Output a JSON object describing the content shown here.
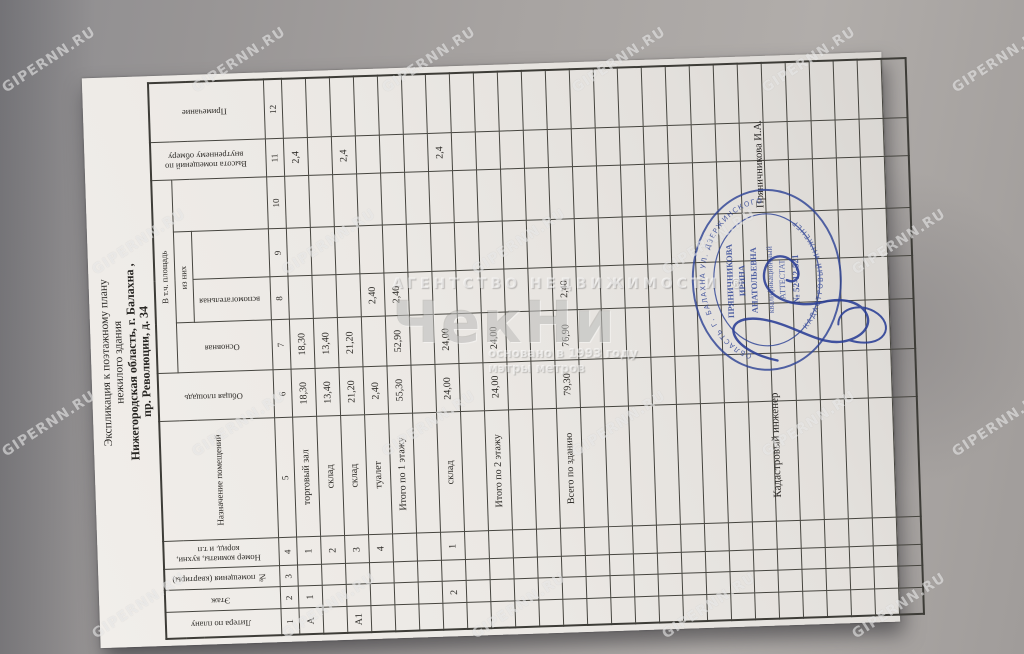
{
  "title": {
    "line1": "Экспликация к поэтажному плану",
    "line2": "нежилого здания",
    "line3": "Нижегородская область, г. Балахна ,",
    "line4": "пр. Революции, д. 34"
  },
  "table": {
    "headers": {
      "col1": "Литера по плану",
      "col2": "Этаж",
      "col3": "№ помещения (квартиры)",
      "col4": "Номер комнаты, кухни, корид. и т.п",
      "col5": "Назначение помещений",
      "col6": "Общая площадь",
      "group7_10": "В т.ч. площадь",
      "col7": "Основная",
      "group8_9": "из них",
      "col8": "вспомогательная",
      "col11": "Высота помещений по внутреннему обмеру",
      "col12": "Примечание"
    },
    "column_numbers": [
      "1",
      "2",
      "3",
      "4",
      "5",
      "6",
      "7",
      "8",
      "9",
      "10",
      "11",
      "12"
    ],
    "rows": [
      [
        "А",
        "1",
        "",
        "1",
        "торговый зал",
        "18,30",
        "18,30",
        "",
        "",
        "",
        "2,4",
        ""
      ],
      [
        "",
        "",
        "",
        "2",
        "склад",
        "13,40",
        "13,40",
        "",
        "",
        "",
        "",
        ""
      ],
      [
        "А1",
        "",
        "",
        "3",
        "склад",
        "21,20",
        "21,20",
        "",
        "",
        "",
        "2,4",
        ""
      ],
      [
        "",
        "",
        "",
        "4",
        "туалет",
        "2,40",
        "",
        "2,40",
        "",
        "",
        "",
        ""
      ],
      [
        "",
        "",
        "",
        "",
        "Итого по 1 этажу",
        "55,30",
        "52,90",
        "2,40",
        "",
        "",
        "",
        ""
      ],
      [
        "",
        "",
        "",
        "",
        "",
        "",
        "",
        "",
        "",
        "",
        "",
        ""
      ],
      [
        "",
        "2",
        "",
        "1",
        "склад",
        "24,00",
        "24,00",
        "",
        "",
        "",
        "2,4",
        ""
      ],
      [
        "",
        "",
        "",
        "",
        "",
        "",
        "",
        "",
        "",
        "",
        "",
        ""
      ],
      [
        "",
        "",
        "",
        "",
        "Итого по 2 этажу",
        "24,00",
        "24,00",
        "",
        "",
        "",
        "",
        ""
      ],
      [
        "",
        "",
        "",
        "",
        "",
        "",
        "",
        "",
        "",
        "",
        "",
        ""
      ],
      [
        "",
        "",
        "",
        "",
        "",
        "",
        "",
        "",
        "",
        "",
        "",
        ""
      ],
      [
        "",
        "",
        "",
        "",
        "Всего по зданию",
        "79,30",
        "76,90",
        "2,40",
        "",
        "",
        "",
        ""
      ],
      [
        "",
        "",
        "",
        "",
        "",
        "",
        "",
        "",
        "",
        "",
        "",
        ""
      ],
      [
        "",
        "",
        "",
        "",
        "",
        "",
        "",
        "",
        "",
        "",
        "",
        ""
      ],
      [
        "",
        "",
        "",
        "",
        "",
        "",
        "",
        "",
        "",
        "",
        "",
        ""
      ],
      [
        "",
        "",
        "",
        "",
        "",
        "",
        "",
        "",
        "",
        "",
        "",
        ""
      ],
      [
        "",
        "",
        "",
        "",
        "",
        "",
        "",
        "",
        "",
        "",
        "",
        ""
      ],
      [
        "",
        "",
        "",
        "",
        "",
        "",
        "",
        "",
        "",
        "",
        "",
        ""
      ],
      [
        "",
        "",
        "",
        "",
        "",
        "",
        "",
        "",
        "",
        "",
        "",
        ""
      ],
      [
        "",
        "",
        "",
        "",
        "",
        "",
        "",
        "",
        "",
        "",
        "",
        ""
      ],
      [
        "",
        "",
        "",
        "",
        "",
        "",
        "",
        "",
        "",
        "",
        "",
        ""
      ],
      [
        "",
        "",
        "",
        "",
        "",
        "",
        "",
        "",
        "",
        "",
        "",
        ""
      ],
      [
        "",
        "",
        "",
        "",
        "",
        "",
        "",
        "",
        "",
        "",
        "",
        ""
      ],
      [
        "",
        "",
        "",
        "",
        "",
        "",
        "",
        "",
        "",
        "",
        "",
        ""
      ],
      [
        "",
        "",
        "",
        "",
        "",
        "",
        "",
        "",
        "",
        "",
        "",
        ""
      ],
      [
        "",
        "",
        "",
        "",
        "",
        "",
        "",
        "",
        "",
        "",
        "",
        ""
      ]
    ]
  },
  "signature": {
    "label": "Кадастровый инженер",
    "name": "Пряничникова И.А."
  },
  "stamp": {
    "ring_address": "ОБЛАСТЬ Г. БАЛАХНА УЛ. ДЗЕРЖИНСКОГО Д. 38",
    "ring_title": "КАДАСТРОВЫЙ ИНЖЕНЕР",
    "name_line1": "ПРЯНИЧНИКОВА",
    "name_line2": "ИРИНА",
    "name_line3": "АНАТОЛЬЕВНА",
    "attest_line1": "квалификационный",
    "attest_line2": "АТТЕСТАТ",
    "attest_line3": "№ 52-12-521"
  },
  "watermark": {
    "tile": "GIPERNN.RU",
    "agency": "АГЕНТСТВО  НЕДВИЖИМОСТИ  ®",
    "logo": "ЧекНи",
    "founded": "основано в 1993 году",
    "slogan": "мэтры метров"
  },
  "colors": {
    "stamp_blue": "#2f4496",
    "paper": "#ebe8e4",
    "background": "#a7a3a1"
  }
}
